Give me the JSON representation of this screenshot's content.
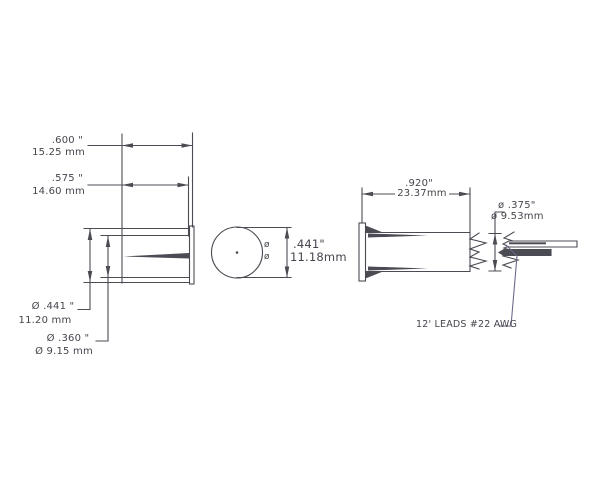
{
  "drawing": {
    "dimensions": {
      "overall_length": {
        "inches": ".600 \"",
        "mm": "15.25 mm"
      },
      "body_length": {
        "inches": ".575 \"",
        "mm": "14.60 mm"
      },
      "flange_diameter": {
        "inches": "Ø .441 \"",
        "mm": "11.20 mm"
      },
      "body_diameter": {
        "inches": "Ø .360 \"",
        "mm": "Ø  9.15 mm"
      },
      "front_diameter": {
        "inches": ".441\"",
        "mm": "11.18mm"
      },
      "front_diameter_symbols": {
        "top": "ø",
        "bottom": "ø"
      },
      "housing_length": {
        "inches": ".920\"",
        "mm": "23.37mm"
      },
      "rear_diameter": {
        "inches": "ø .375\"",
        "mm": "ø 9.53mm"
      }
    },
    "annotations": {
      "leads": "12' LEADS #22 AWG"
    },
    "colors": {
      "line": "#4b4b54",
      "text": "#45454e",
      "leader": "#6e6888",
      "background": "#ffffff"
    }
  }
}
